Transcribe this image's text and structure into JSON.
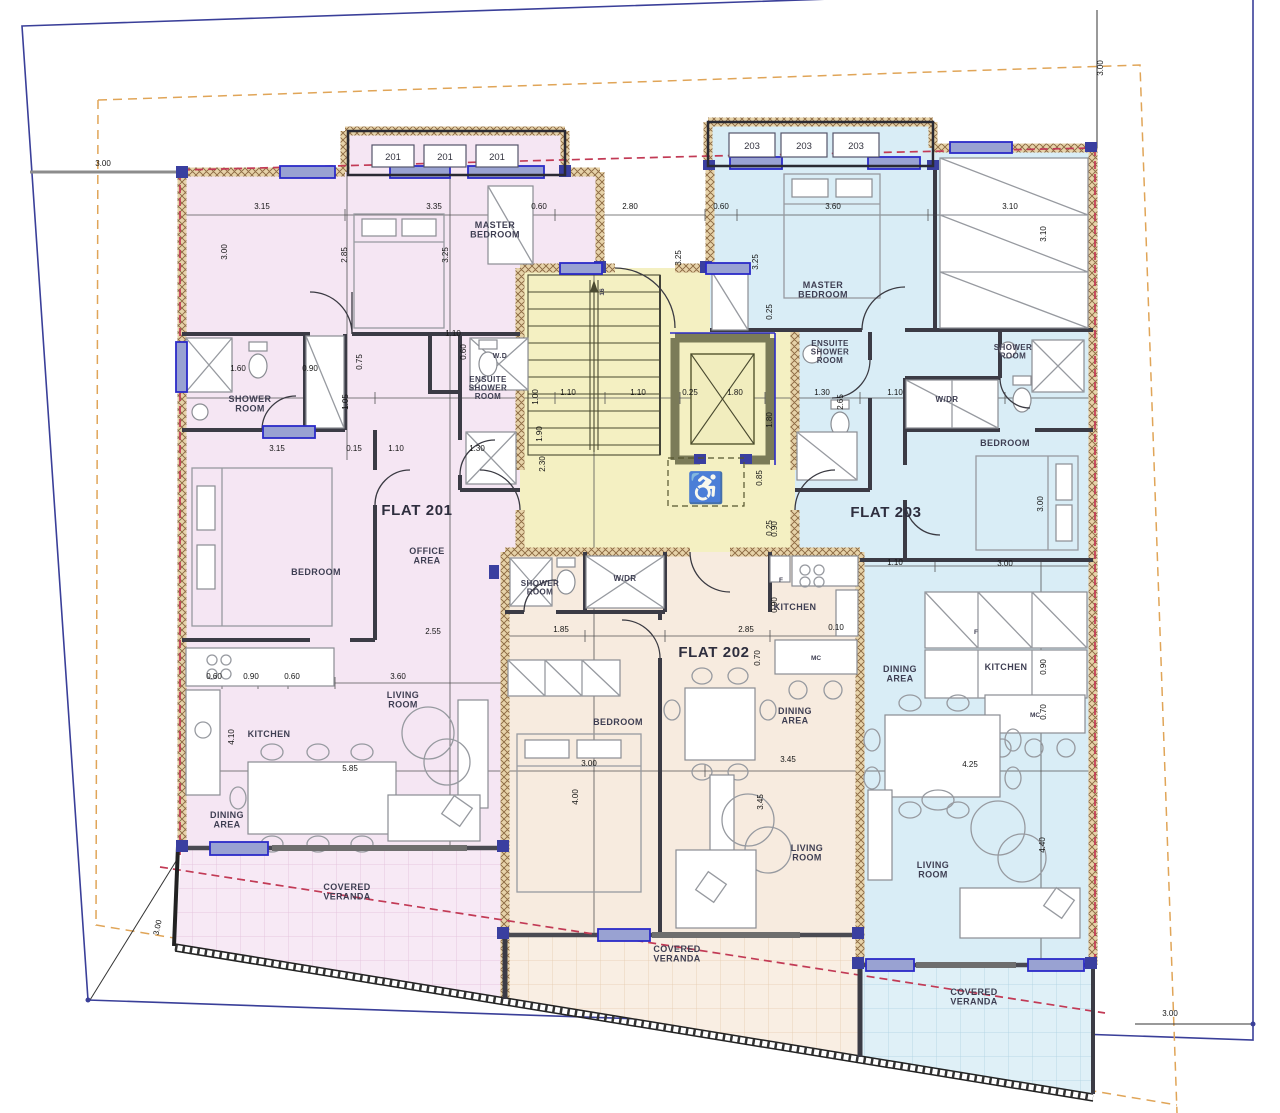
{
  "colors": {
    "flat201_fill": "#F5E6F3",
    "flat202_fill": "#F7EBDF",
    "flat203_fill": "#D9EDF6",
    "core_fill": "#F4F0C2",
    "veranda201_fill": "#F7E9F5",
    "veranda202_fill": "#F9EEE3",
    "veranda203_fill": "#DFF0F7",
    "wall_hatch_bg": "#E6D2A8",
    "wall_hatch_line": "#8A6740",
    "window_frame": "#2B2BC8",
    "window_fill": "#99A2D2",
    "plot_boundary": "#3A3F99",
    "setback_line": "#E0A558",
    "overhang_line": "#C23A55"
  },
  "unit_tags": [
    {
      "t": "201",
      "x": 372,
      "y": 145,
      "w": 42,
      "h": 22,
      "n": "unit-tag-201-a"
    },
    {
      "t": "201",
      "x": 424,
      "y": 145,
      "w": 42,
      "h": 22,
      "n": "unit-tag-201-b"
    },
    {
      "t": "201",
      "x": 476,
      "y": 145,
      "w": 42,
      "h": 22,
      "n": "unit-tag-201-c"
    },
    {
      "t": "203",
      "x": 729,
      "y": 133,
      "w": 46,
      "h": 24,
      "n": "unit-tag-203-a"
    },
    {
      "t": "203",
      "x": 781,
      "y": 133,
      "w": 46,
      "h": 24,
      "n": "unit-tag-203-b"
    },
    {
      "t": "203",
      "x": 833,
      "y": 133,
      "w": 46,
      "h": 24,
      "n": "unit-tag-203-c"
    }
  ],
  "room_labels": [
    {
      "t": "MASTER\nBEDROOM",
      "x": 495,
      "y": 228,
      "n": "label-master-bedroom-201"
    },
    {
      "t": "MASTER\nBEDROOM",
      "x": 823,
      "y": 288,
      "n": "label-master-bedroom-203"
    },
    {
      "t": "SHOWER\nROOM",
      "x": 250,
      "y": 402,
      "n": "label-shower-room-201"
    },
    {
      "t": "W.D",
      "x": 500,
      "y": 358,
      "fs": 7,
      "n": "label-wd-201"
    },
    {
      "t": "ENSUITE\nSHOWER\nROOM",
      "x": 488,
      "y": 382,
      "fs": 8,
      "n": "label-ensuite-201"
    },
    {
      "t": "ENSUITE\nSHOWER\nROOM",
      "x": 830,
      "y": 346,
      "fs": 8,
      "n": "label-ensuite-203"
    },
    {
      "t": "SHOWER\nROOM",
      "x": 1013,
      "y": 350,
      "fs": 8,
      "n": "label-shower-room-203"
    },
    {
      "t": "W/DR",
      "x": 947,
      "y": 402,
      "fs": 8,
      "n": "label-wdr-203"
    },
    {
      "t": "BEDROOM",
      "x": 1005,
      "y": 446,
      "n": "label-bedroom-203"
    },
    {
      "t": "FLAT 201",
      "x": 417,
      "y": 515,
      "cls": "flat",
      "n": "label-flat-201"
    },
    {
      "t": "FLAT 202",
      "x": 714,
      "y": 657,
      "cls": "flat",
      "n": "label-flat-202"
    },
    {
      "t": "FLAT 203",
      "x": 886,
      "y": 517,
      "cls": "flat",
      "n": "label-flat-203"
    },
    {
      "t": "BEDROOM",
      "x": 316,
      "y": 575,
      "n": "label-bedroom-201"
    },
    {
      "t": "OFFICE\nAREA",
      "x": 427,
      "y": 554,
      "n": "label-office-area-201"
    },
    {
      "t": "SHOWER\nROOM",
      "x": 540,
      "y": 586,
      "fs": 8,
      "n": "label-shower-room-202"
    },
    {
      "t": "W/DR",
      "x": 625,
      "y": 581,
      "fs": 8,
      "n": "label-wdr-202"
    },
    {
      "t": "KITCHEN",
      "x": 795,
      "y": 610,
      "n": "label-kitchen-202"
    },
    {
      "t": "DINING\nAREA",
      "x": 795,
      "y": 714,
      "n": "label-dining-area-202"
    },
    {
      "t": "BEDROOM",
      "x": 618,
      "y": 725,
      "n": "label-bedroom-202"
    },
    {
      "t": "KITCHEN",
      "x": 269,
      "y": 737,
      "n": "label-kitchen-201"
    },
    {
      "t": "LIVING\nROOM",
      "x": 403,
      "y": 698,
      "n": "label-living-room-201"
    },
    {
      "t": "DINING\nAREA",
      "x": 227,
      "y": 818,
      "n": "label-dining-area-201"
    },
    {
      "t": "DINING\nAREA",
      "x": 900,
      "y": 672,
      "n": "label-dining-area-203"
    },
    {
      "t": "KITCHEN",
      "x": 1006,
      "y": 670,
      "n": "label-kitchen-203"
    },
    {
      "t": "LIVING\nROOM",
      "x": 807,
      "y": 851,
      "n": "label-living-room-202"
    },
    {
      "t": "LIVING\nROOM",
      "x": 933,
      "y": 868,
      "n": "label-living-room-203"
    },
    {
      "t": "COVERED\nVERANDA",
      "x": 347,
      "y": 890,
      "n": "label-covered-veranda-201"
    },
    {
      "t": "COVERED\nVERANDA",
      "x": 677,
      "y": 952,
      "n": "label-covered-veranda-202"
    },
    {
      "t": "COVERED\nVERANDA",
      "x": 974,
      "y": 995,
      "n": "label-covered-veranda-203"
    },
    {
      "t": "MC",
      "x": 816,
      "y": 660,
      "cls": "tiny",
      "n": "label-appliance-202"
    },
    {
      "t": "MC",
      "x": 1035,
      "y": 717,
      "cls": "tiny",
      "n": "label-appliance-203"
    },
    {
      "t": "F",
      "x": 781,
      "y": 582,
      "cls": "tiny",
      "n": "label-fridge-202"
    },
    {
      "t": "F",
      "x": 976,
      "y": 634,
      "cls": "tiny",
      "n": "label-fridge-203"
    },
    {
      "t": "16",
      "x": 604,
      "y": 292,
      "cls": "tiny",
      "r": -90,
      "n": "label-stair-count"
    }
  ],
  "dim_labels": [
    {
      "t": "3.00",
      "x": 103,
      "y": 166,
      "n": "dim-site-left"
    },
    {
      "t": "3.00",
      "x": 1103,
      "y": 68,
      "r": -90,
      "n": "dim-site-top-right"
    },
    {
      "t": "3.00",
      "x": 160,
      "y": 928,
      "r": -78,
      "n": "dim-site-bottom-left"
    },
    {
      "t": "3.00",
      "x": 1170,
      "y": 1016,
      "n": "dim-site-bottom-right"
    },
    {
      "t": "3.15",
      "x": 262,
      "y": 209
    },
    {
      "t": "3.35",
      "x": 434,
      "y": 209
    },
    {
      "t": "0.60",
      "x": 539,
      "y": 209
    },
    {
      "t": "2.80",
      "x": 630,
      "y": 209
    },
    {
      "t": "0.60",
      "x": 721,
      "y": 209
    },
    {
      "t": "3.60",
      "x": 833,
      "y": 209
    },
    {
      "t": "3.10",
      "x": 1010,
      "y": 209
    },
    {
      "t": "3.00",
      "x": 227,
      "y": 252,
      "r": -90
    },
    {
      "t": "2.85",
      "x": 347,
      "y": 255,
      "r": -90
    },
    {
      "t": "3.25",
      "x": 448,
      "y": 255,
      "r": -90
    },
    {
      "t": "3.25",
      "x": 681,
      "y": 258,
      "r": -90
    },
    {
      "t": "3.25",
      "x": 758,
      "y": 262,
      "r": -90
    },
    {
      "t": "3.10",
      "x": 1046,
      "y": 234,
      "r": -90
    },
    {
      "t": "1.60",
      "x": 238,
      "y": 371
    },
    {
      "t": "0.90",
      "x": 310,
      "y": 371
    },
    {
      "t": "1.10",
      "x": 453,
      "y": 336
    },
    {
      "t": "0.75",
      "x": 362,
      "y": 362,
      "r": -90
    },
    {
      "t": "0.60",
      "x": 466,
      "y": 352,
      "r": -90
    },
    {
      "t": "3.15",
      "x": 277,
      "y": 451
    },
    {
      "t": "0.15",
      "x": 354,
      "y": 451
    },
    {
      "t": "1.10",
      "x": 396,
      "y": 451
    },
    {
      "t": "1.30",
      "x": 477,
      "y": 451
    },
    {
      "t": "1.05",
      "x": 348,
      "y": 402,
      "r": -90
    },
    {
      "t": "1.00",
      "x": 538,
      "y": 397,
      "r": -90
    },
    {
      "t": "1.90",
      "x": 542,
      "y": 434,
      "r": -90
    },
    {
      "t": "2.65",
      "x": 843,
      "y": 402,
      "r": -90
    },
    {
      "t": "2.30",
      "x": 545,
      "y": 464,
      "r": -90
    },
    {
      "t": "0.85",
      "x": 762,
      "y": 478,
      "r": -90
    },
    {
      "t": "1.10",
      "x": 568,
      "y": 395
    },
    {
      "t": "1.10",
      "x": 638,
      "y": 395
    },
    {
      "t": "0.25",
      "x": 690,
      "y": 395
    },
    {
      "t": "1.80",
      "x": 735,
      "y": 395
    },
    {
      "t": "0.25",
      "x": 772,
      "y": 312,
      "r": -90
    },
    {
      "t": "1.80",
      "x": 772,
      "y": 420,
      "r": -90
    },
    {
      "t": "0.25",
      "x": 772,
      "y": 528,
      "r": -90
    },
    {
      "t": "1.30",
      "x": 822,
      "y": 395
    },
    {
      "t": "1.10",
      "x": 895,
      "y": 395
    },
    {
      "t": "1.10",
      "x": 895,
      "y": 565
    },
    {
      "t": "3.00",
      "x": 1005,
      "y": 566
    },
    {
      "t": "3.00",
      "x": 1043,
      "y": 504,
      "r": -90
    },
    {
      "t": "1.85",
      "x": 561,
      "y": 632
    },
    {
      "t": "2.85",
      "x": 746,
      "y": 632
    },
    {
      "t": "0.10",
      "x": 836,
      "y": 630
    },
    {
      "t": "0.70",
      "x": 760,
      "y": 658,
      "r": -90
    },
    {
      "t": "0.90",
      "x": 777,
      "y": 529,
      "r": -90
    },
    {
      "t": "0.90",
      "x": 777,
      "y": 605,
      "r": -90
    },
    {
      "t": "2.55",
      "x": 433,
      "y": 634
    },
    {
      "t": "3.60",
      "x": 398,
      "y": 679
    },
    {
      "t": "0.60",
      "x": 214,
      "y": 679
    },
    {
      "t": "0.90",
      "x": 251,
      "y": 679
    },
    {
      "t": "0.60",
      "x": 292,
      "y": 679
    },
    {
      "t": "5.85",
      "x": 350,
      "y": 771
    },
    {
      "t": "4.10",
      "x": 234,
      "y": 737,
      "r": -90
    },
    {
      "t": "3.00",
      "x": 589,
      "y": 766
    },
    {
      "t": "4.00",
      "x": 578,
      "y": 797,
      "r": -90
    },
    {
      "t": "3.45",
      "x": 788,
      "y": 762
    },
    {
      "t": "3.45",
      "x": 763,
      "y": 802,
      "r": -90
    },
    {
      "t": "4.25",
      "x": 970,
      "y": 767
    },
    {
      "t": "0.90",
      "x": 1046,
      "y": 667,
      "r": -90
    },
    {
      "t": "0.70",
      "x": 1046,
      "y": 712,
      "r": -90
    },
    {
      "t": "4.40",
      "x": 1045,
      "y": 845,
      "r": -90
    }
  ],
  "windows": [
    {
      "x": 280,
      "y": 166,
      "w": 55,
      "h": 12
    },
    {
      "x": 390,
      "y": 166,
      "w": 60,
      "h": 12
    },
    {
      "x": 468,
      "y": 166,
      "w": 76,
      "h": 12
    },
    {
      "x": 730,
      "y": 157,
      "w": 52,
      "h": 12
    },
    {
      "x": 868,
      "y": 157,
      "w": 52,
      "h": 12
    },
    {
      "x": 950,
      "y": 142,
      "w": 62,
      "h": 11
    },
    {
      "x": 560,
      "y": 263,
      "w": 42,
      "h": 11
    },
    {
      "x": 706,
      "y": 263,
      "w": 44,
      "h": 11
    },
    {
      "x": 176,
      "y": 342,
      "w": 11,
      "h": 50
    },
    {
      "x": 263,
      "y": 426,
      "w": 52,
      "h": 12
    },
    {
      "x": 210,
      "y": 842,
      "w": 58,
      "h": 13
    },
    {
      "x": 598,
      "y": 929,
      "w": 52,
      "h": 12
    },
    {
      "x": 866,
      "y": 959,
      "w": 48,
      "h": 12
    },
    {
      "x": 1028,
      "y": 959,
      "w": 56,
      "h": 12
    }
  ]
}
